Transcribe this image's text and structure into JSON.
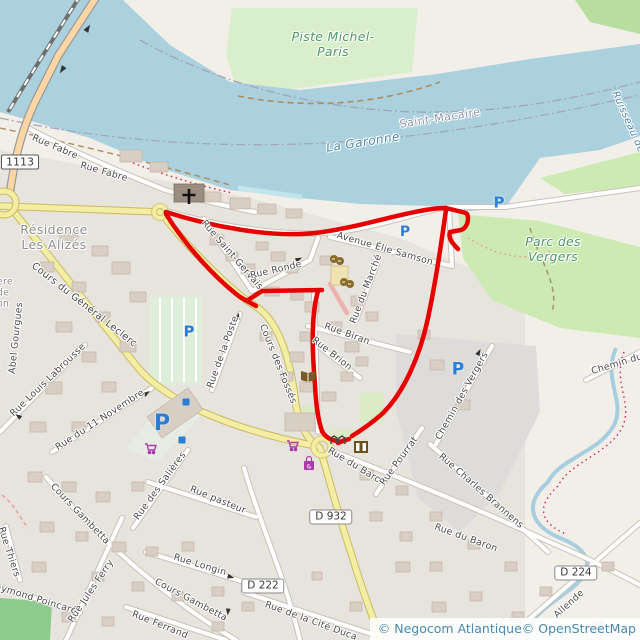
{
  "attribution": {
    "text": "© Negocom Atlantique© OpenStreetMap"
  },
  "shields": {
    "bridge": "1113",
    "d932": "D 932",
    "d222": "D 222",
    "d224": "D 224"
  },
  "parking": {
    "letter": "P"
  },
  "places": {
    "piste": "Piste Michel-\nParis",
    "parc": "Parc des\nVergers",
    "residence": "Résidence\nLes Alizés",
    "saint_macaire": "Saint-Macaire"
  },
  "water": {
    "garonne": "La Garonne",
    "ruisseau": "Ruisseau de"
  },
  "streets": {
    "fabre1": "Rue Fabre",
    "fabre2": "Rue Fabre",
    "saint_gervais": "Rue Saint-Gervais",
    "ronde": "Rue Ronde",
    "avenue_elie": "Avenue Élie Samson",
    "marche": "Rue du Marché",
    "biran": "Rue Biran",
    "brion": "Rue Brion",
    "poste": "Rue de la Poste",
    "fosses": "Cours des Fossés",
    "leclerc": "Cours du Général Leclerc",
    "gourgues": "Abel Gourgues",
    "edge_fragments": "ère\nde\non",
    "labrousse": "Rue Louis Labrousse",
    "novembre": "Rue du 11 Novembre",
    "salieres": "Rue des Salières",
    "gambetta1": "Cours Gambetta",
    "gambetta2": "Cours Gambetta",
    "pasteur": "Rue pasteur",
    "longin": "Rue Longin",
    "ferrand": "Rue Ferrand",
    "thiers": "Rue Thiers",
    "poincare": "Raymond Poincaré",
    "jules_ferry": "Rue Jules Ferry",
    "baron1": "Rue du Baron",
    "baron2": "Rue du Baron",
    "pourrat": "Rue Pourrat",
    "brannens": "Rue Charles Brannens",
    "vergers_chemin": "Chemin des Vergers",
    "chemin_du": "Chemin du",
    "allende": "Allende",
    "cite": "Rue de la Cité Duca"
  },
  "icons": {
    "church": "christian-cross",
    "theatre": "theatre-masks",
    "library": "open-book",
    "cinema": "film-strip",
    "gate_glyph": "∏∏",
    "supermarket": "shopping-cart",
    "mall": "shopping-bag",
    "parking": "P-square"
  },
  "colors": {
    "route": "#e60000",
    "water": "#abd1df",
    "park": "#cdeab3",
    "road_secondary": "#f3eea4",
    "road_primary": "#fcd6a4",
    "parking_blue": "#2a7fd4",
    "shop_magenta": "#ac39ac",
    "amenity_brown": "#7a5b28"
  }
}
